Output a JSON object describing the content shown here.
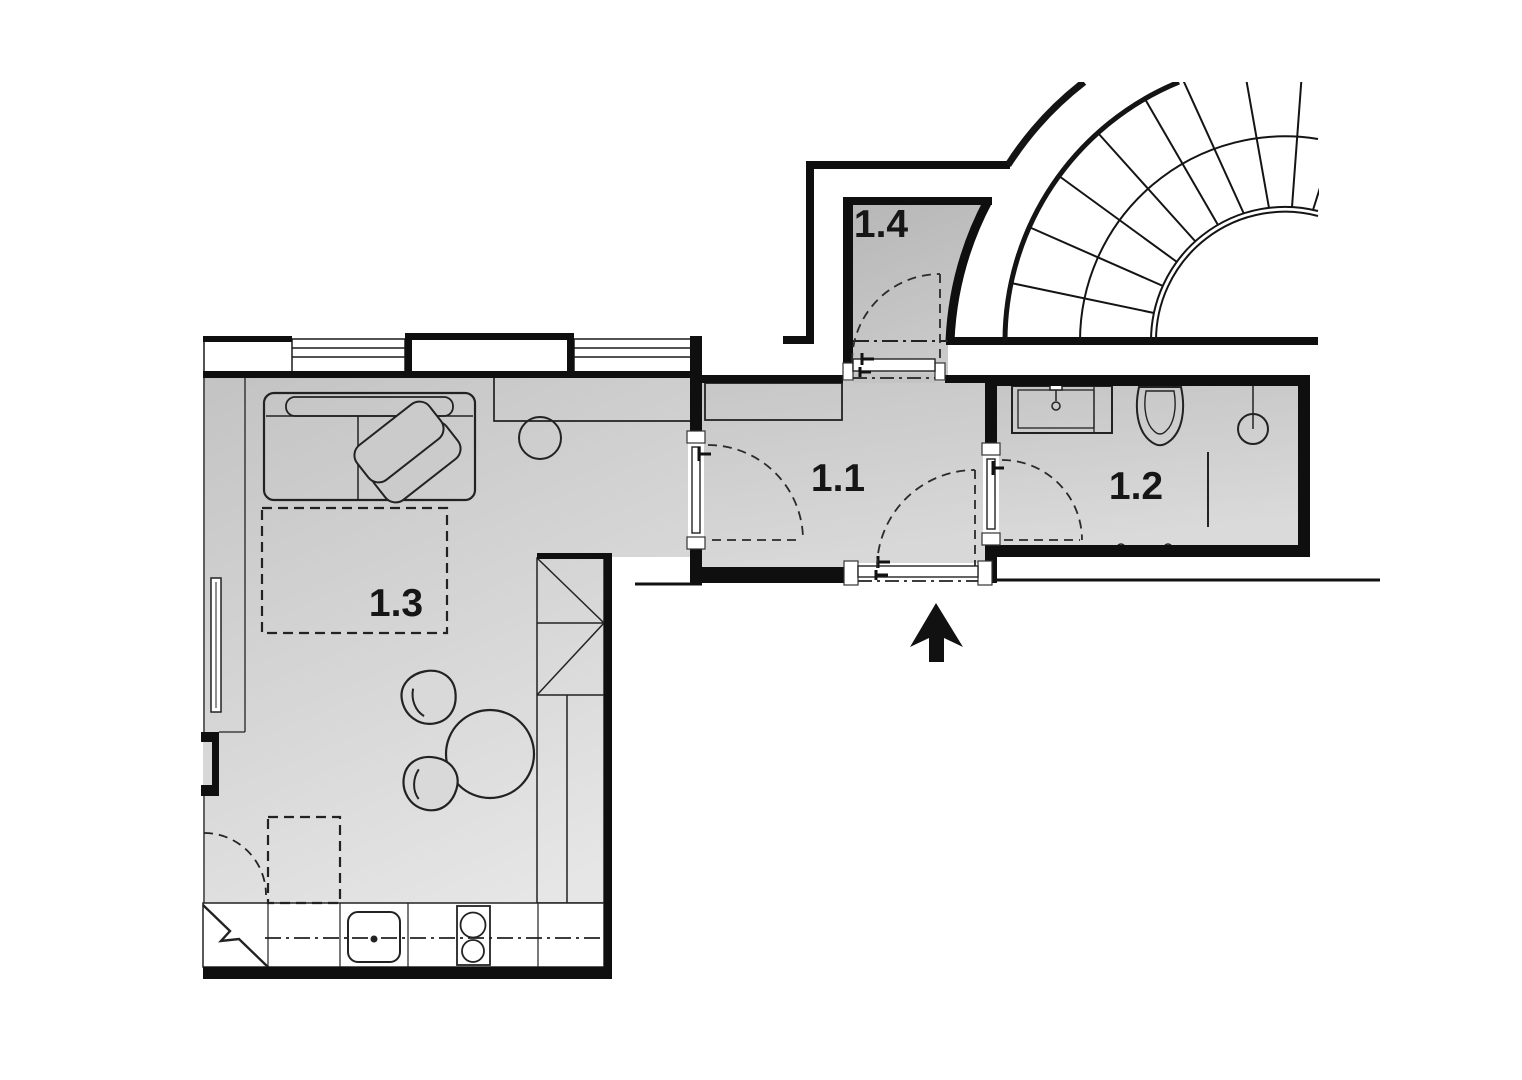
{
  "page": {
    "type": "architectural-floor-plan",
    "background": "#ffffff"
  },
  "rooms": [
    {
      "label": "1.1"
    },
    {
      "label": "1.2"
    },
    {
      "label": "1.3"
    },
    {
      "label": "1.4"
    }
  ],
  "entrance": {
    "arrow_direction": "up"
  },
  "colors": {
    "wall": "#0f0f0f",
    "line": "#222222",
    "dashed": "#2a2a2a",
    "label": "#161616",
    "arrow": "#111111",
    "room_fill_dark": "#c5c5c5",
    "room_fill_light": "#e5e5e5",
    "entry_fill_dark": "#b9b9b9",
    "entry_fill_light": "#cacaca",
    "background": "#ffffff"
  },
  "fixtures": [
    "spiral-staircase",
    "sofa",
    "seat-cushion",
    "seat-cushion",
    "bed-dashed-outline",
    "round-table",
    "chair",
    "chair",
    "wardrobe",
    "kitchen-counter",
    "kitchen-sink",
    "cooktop",
    "radiator",
    "hall-closet",
    "washbasin",
    "toilet",
    "shower",
    "towel-rail",
    "door-swing",
    "entrance-arrow"
  ]
}
